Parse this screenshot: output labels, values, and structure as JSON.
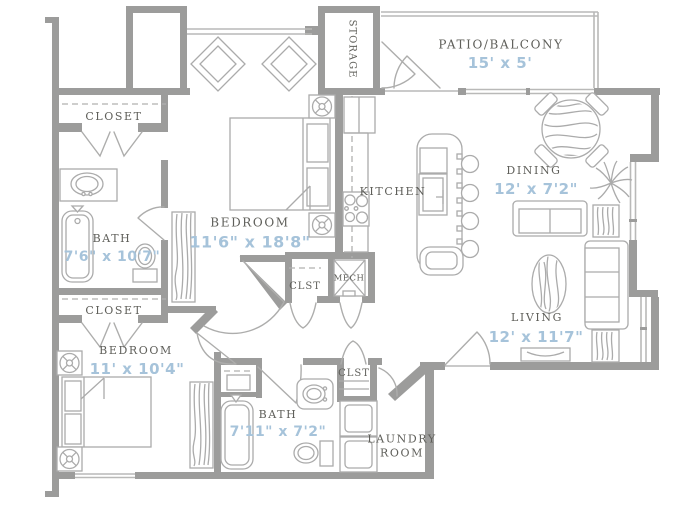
{
  "colors": {
    "wall": "#9c9c9b",
    "furniture_line": "#ababab",
    "window_line": "#b9b9b8",
    "label_text": "#5f5f5a",
    "dimension_text": "#a6c3da"
  },
  "rooms": {
    "patio": {
      "label": "PATIO/BALCONY",
      "dim": "15' x 5'"
    },
    "storage": {
      "label": "STORAGE"
    },
    "closet_top": {
      "label": "CLOSET"
    },
    "bath1": {
      "label": "BATH",
      "dim": "7'6\" x 10'7\""
    },
    "bedroom1": {
      "label": "BEDROOM",
      "dim": "11'6\" x 18'8\""
    },
    "kitchen": {
      "label": "KITCHEN"
    },
    "dining": {
      "label": "DINING",
      "dim": "12' x 7'2\""
    },
    "hall_closet": {
      "label": "CLST"
    },
    "mech": {
      "label": "MECH"
    },
    "closet_mid": {
      "label": "CLOSET"
    },
    "bedroom2": {
      "label": "BEDROOM",
      "dim": "11' x 10'4\""
    },
    "bath_closet": {
      "label": "CLST"
    },
    "bath2": {
      "label": "BATH",
      "dim": "7'11\" x 7'2\""
    },
    "laundry": {
      "line1": "LAUNDRY",
      "line2": "ROOM"
    },
    "living": {
      "label": "LIVING",
      "dim": "12' x 11'7\""
    }
  }
}
